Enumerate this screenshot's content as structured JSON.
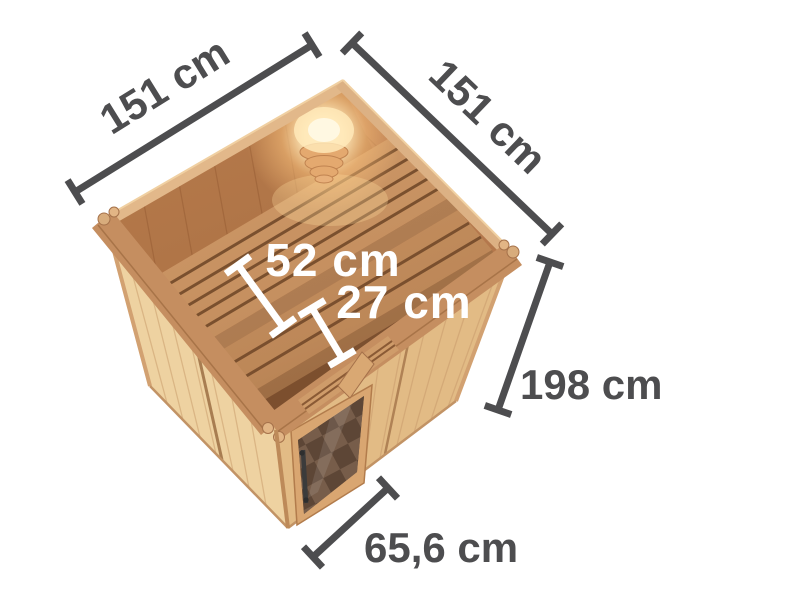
{
  "scene": {
    "name": "sauna-dimension-diagram",
    "background": "#ffffff"
  },
  "colors": {
    "dimension_line": "#4d4d4f",
    "label_dark": "#4d4d4f",
    "label_light": "#ffffff",
    "wood_exterior_light": "#eed2a1",
    "wood_exterior_shade": "#e2bb85",
    "wood_rim": "#c58e60",
    "wood_interior": "#c08255",
    "wood_interior_left": "#b67a4b",
    "wood_bench": "#d29c6a",
    "bench_gap": "#7a5130",
    "door_frame": "#d9a671",
    "door_glass": "#5d4636",
    "door_glass_tile": "#7b614e",
    "handle": "#3b3b3b",
    "lamp_glow": "#ffe9b8",
    "lamp_core": "#fff8e2"
  },
  "dimensions": {
    "width_left": {
      "label": "151 cm"
    },
    "width_right": {
      "label": "151 cm"
    },
    "bench_depth": {
      "label": "52 cm"
    },
    "bench_step_depth": {
      "label": "27 cm"
    },
    "height": {
      "label": "198 cm"
    },
    "door_width": {
      "label": "65,6 cm"
    }
  }
}
